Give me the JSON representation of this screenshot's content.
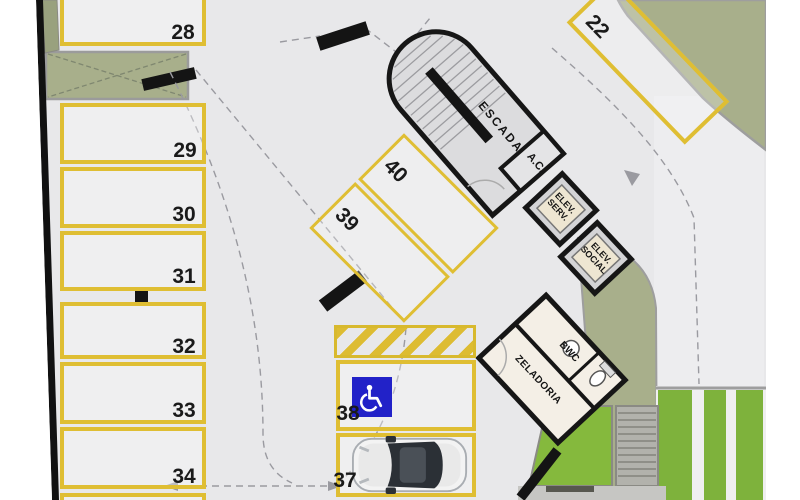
{
  "plan": {
    "spaces": {
      "left": [
        {
          "label": "28"
        },
        {
          "label": "29"
        },
        {
          "label": "30"
        },
        {
          "label": "31"
        },
        {
          "label": "32"
        },
        {
          "label": "33"
        },
        {
          "label": "34"
        }
      ],
      "diagonal": [
        {
          "label": "40"
        },
        {
          "label": "39"
        }
      ],
      "bottom": [
        {
          "label": "38"
        },
        {
          "label": "37"
        }
      ],
      "ramp": [
        {
          "label": "22"
        }
      ]
    },
    "rooms": {
      "stair": "ESCADA",
      "ac": "A.C.",
      "elev_serv": "ELEV. SERV.",
      "elev_social": "ELEV. SOCIAL",
      "bwc": "BWC",
      "janitor": "ZELADORIA"
    },
    "colors": {
      "parking_line": "#dfbe33",
      "handicap_blue": "#2222c8",
      "wall_black": "#141414",
      "olive_green": "#a8af8b",
      "grass_green": "#85b93d",
      "floor_grey": "#e8e8ea"
    }
  }
}
